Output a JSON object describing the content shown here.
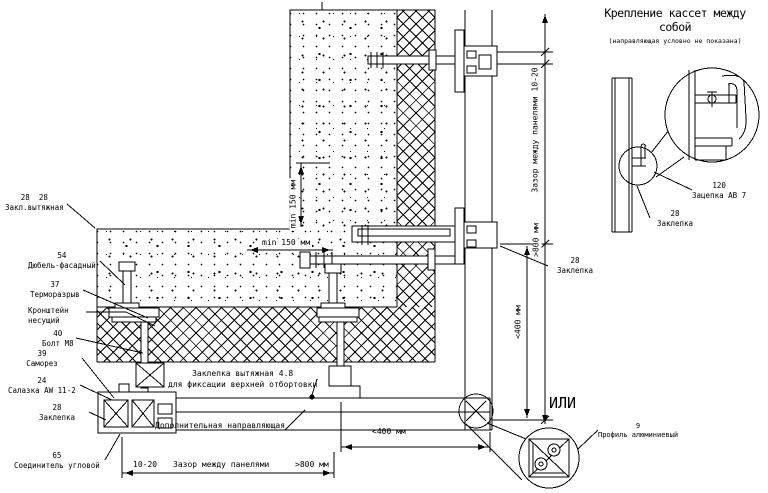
{
  "title": {
    "main": "Крепление кассет между собой",
    "sub": "(направляющая условно не показана)"
  },
  "callouts": {
    "rivet_pair": {
      "num": "28  28",
      "label": "Закл.вытяжная"
    },
    "dowel": {
      "num": "54",
      "label": "Дюбель-фасадный"
    },
    "thermal_break": {
      "num": "37",
      "label": "Терморазрыв"
    },
    "bracket": {
      "line1": "Кронштейн",
      "line2": "несущий"
    },
    "bolt": {
      "num": "40",
      "label": "Болт М8"
    },
    "screw": {
      "num": "39",
      "label": "Саморез"
    },
    "slide": {
      "num": "24",
      "label": "Салазка AW 11-2"
    },
    "rivet_left": {
      "num": "28",
      "label": "Заклепка"
    },
    "corner_connector": {
      "num": "65",
      "label": "Соединитель угловой"
    },
    "blind_rivet": {
      "line1": "Заклепка вытяжная 4.8",
      "line2": "для фиксации верхней отбортовки"
    },
    "extra_guide": {
      "label": "Дополнительная направляющая"
    },
    "rivet_right": {
      "num": "28",
      "label": "Заклепка"
    },
    "hook": {
      "num": "120",
      "label": "Зацепка АВ 7"
    },
    "rivet_detail": {
      "num": "28",
      "label": "Заклепка"
    },
    "alu_profile": {
      "num": "9",
      "label": "Профиль алюминиевый"
    }
  },
  "dimensions": {
    "min150_v": "min 150 мм",
    "min150_h": "min 150 мм",
    "gap_vertical": "Зазор между панелями 10-20",
    "v800": ">800 мм",
    "v400": "<400 мм",
    "h400": "<400 мм",
    "bottom_gap": "10-20",
    "bottom_label": "Зазор между панелями",
    "bottom_800": ">800 мм"
  },
  "or_text": "ИЛИ",
  "colors": {
    "line": "#000000",
    "background": "#ffffff"
  }
}
